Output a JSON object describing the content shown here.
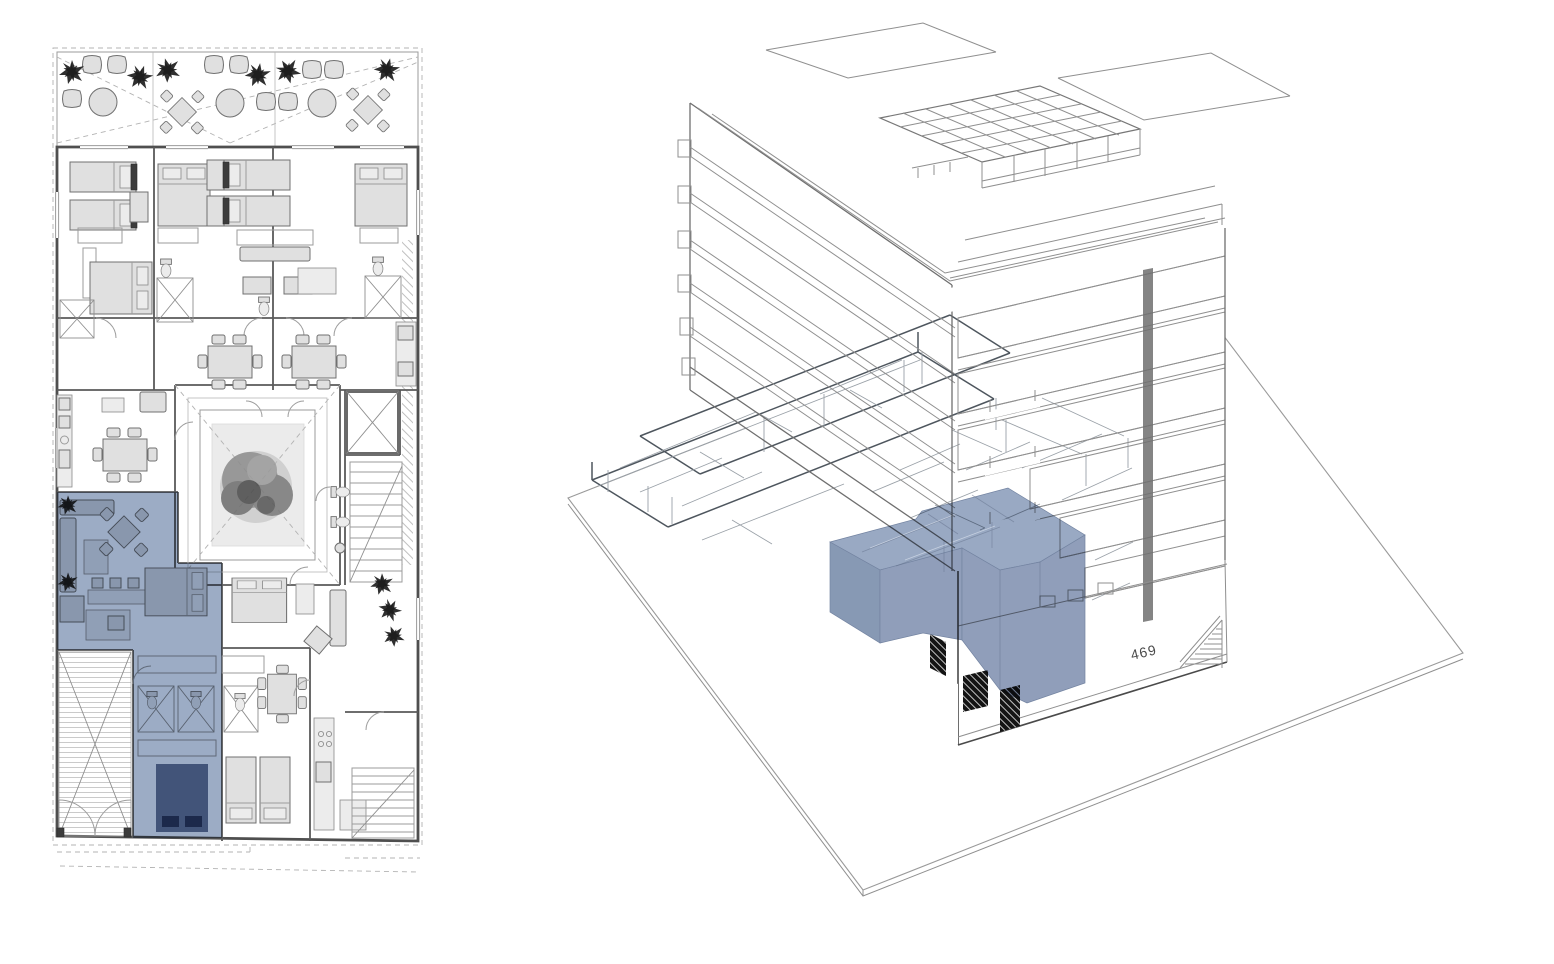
{
  "figure": {
    "kind": "architectural-presentation",
    "background": "#ffffff"
  },
  "colors": {
    "highlight_blue": "#7d92b3",
    "highlight_top": "#8296b6",
    "highlight_left": "#6d82a4",
    "highlight_right": "#7789ab",
    "highlight_dark": "#5b6e92",
    "wall_gray": "#4f4f4f",
    "wireframe_gray": "#9aa1a8",
    "opening_black": "#111111"
  },
  "floor_plan": {
    "name": "ground-floor-plan",
    "highlighted_unit": {
      "name": "selected-apartment-plan"
    }
  },
  "axon": {
    "name": "building-axonometric",
    "unit_number_label": "469",
    "highlighted_unit": {
      "name": "selected-apartment-volume"
    }
  }
}
